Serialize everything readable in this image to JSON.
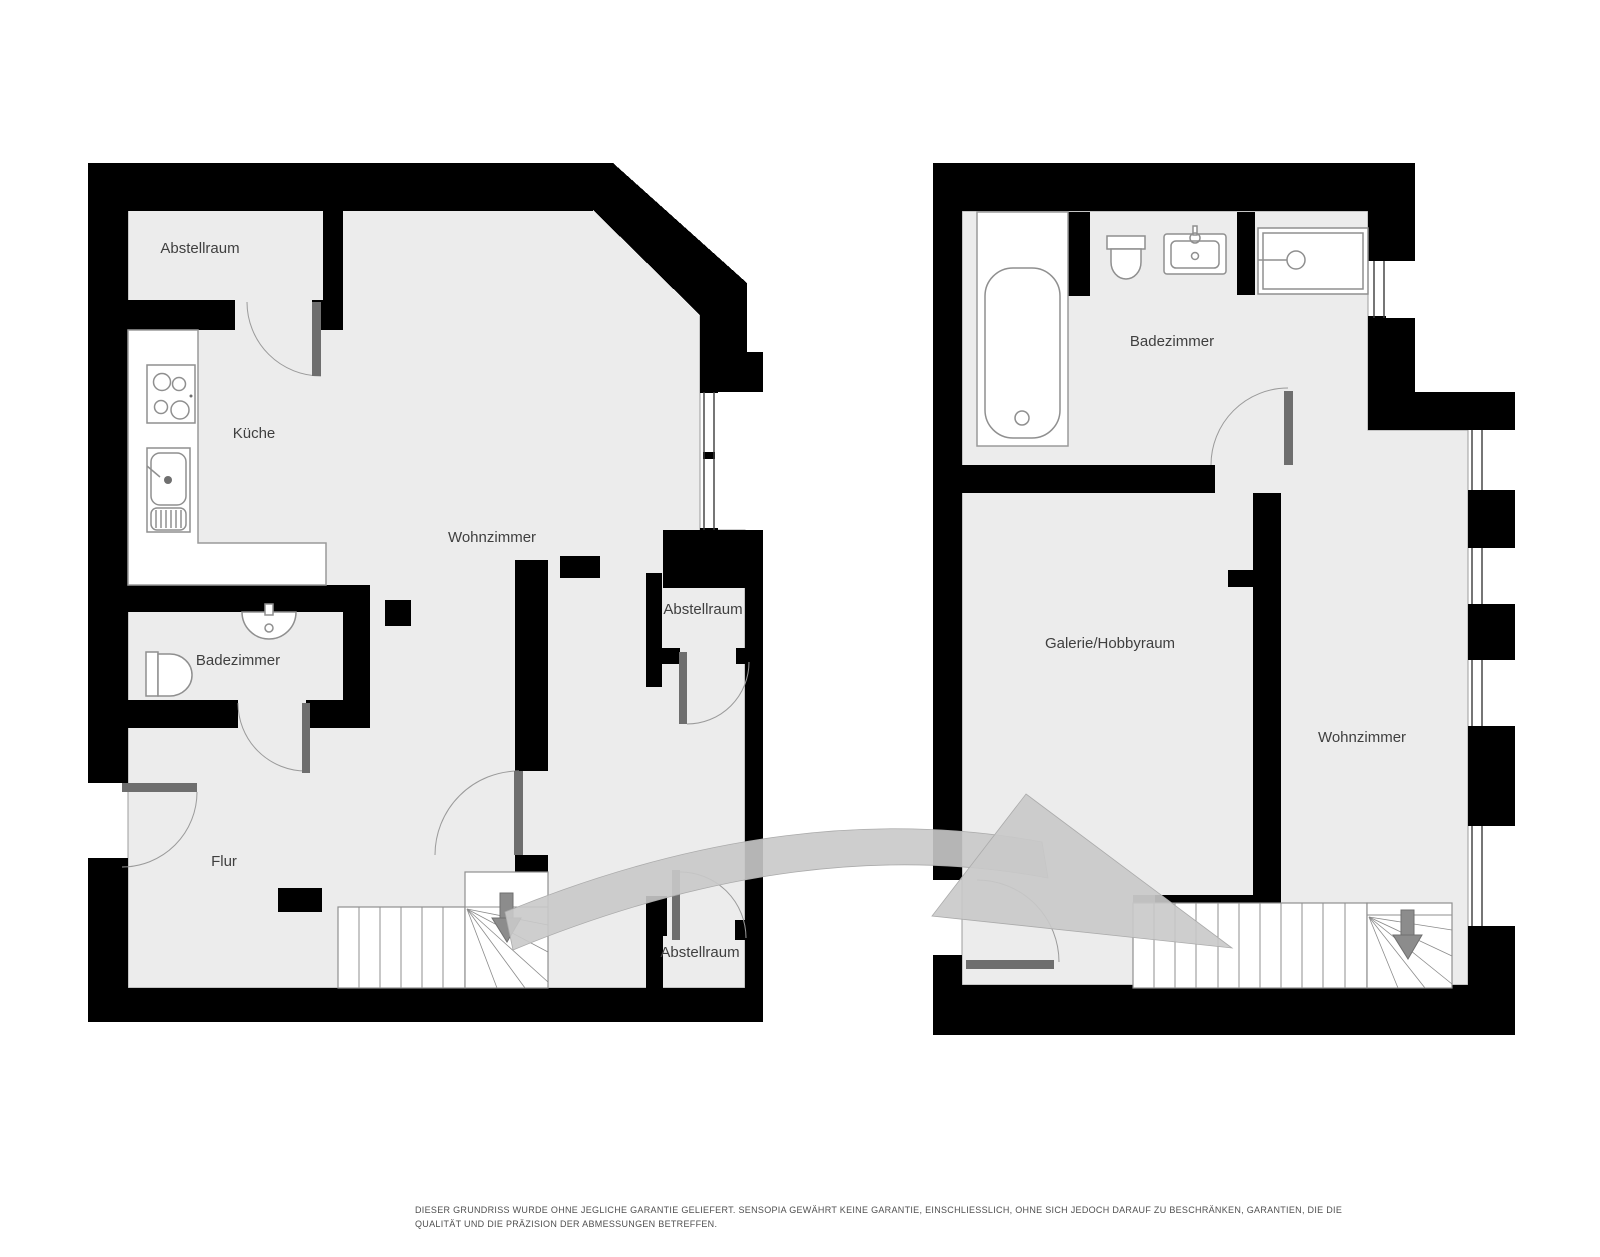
{
  "colors": {
    "wall": "#000000",
    "floor": "#ececec",
    "door_leaf": "#6e6e6e",
    "transition_arrow": "#c9c9c9",
    "label_text": "#3f3f3f",
    "background": "#ffffff"
  },
  "plans": {
    "left": {
      "rooms": {
        "abstellraum_top": "Abstellraum",
        "kueche": "Küche",
        "wohnzimmer": "Wohnzimmer",
        "abstellraum_mid": "Abstellraum",
        "badezimmer": "Badezimmer",
        "flur": "Flur",
        "abstellraum_bottom": "Abstellraum"
      }
    },
    "right": {
      "rooms": {
        "badezimmer": "Badezimmer",
        "galerie": "Galerie/Hobbyraum",
        "wohnzimmer": "Wohnzimmer"
      }
    }
  },
  "icons": {
    "stairs_left": "stairs-down-arrow",
    "stairs_right": "stairs-down-arrow",
    "transition": "floor-transition-arrow",
    "kitchen": [
      "stove-icon",
      "kitchen-sink-icon",
      "counter"
    ],
    "bath_left": [
      "toilet-icon",
      "washbasin-icon"
    ],
    "bath_right": [
      "bathtub-icon",
      "toilet-icon",
      "washbasin-icon",
      "shower-icon"
    ]
  },
  "disclaimer": {
    "line1": "DIESER GRUNDRISS WURDE OHNE JEGLICHE GARANTIE GELIEFERT. SENSOPIA GEWÄHRT KEINE GARANTIE, EINSCHLIESSLICH, OHNE SICH JEDOCH DARAUF ZU BESCHRÄNKEN, GARANTIEN, DIE DIE",
    "line2": "QUALITÄT UND DIE PRÄZISION DER ABMESSUNGEN BETREFFEN."
  }
}
